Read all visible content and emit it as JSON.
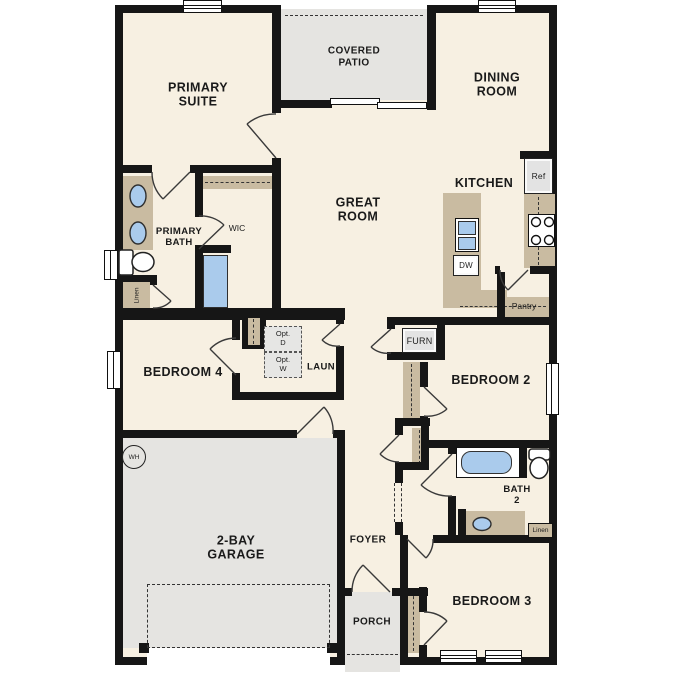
{
  "plan": {
    "colors": {
      "wall": "#161616",
      "floor": "#f7f0e2",
      "outdoor": "#e5e4e1",
      "counter": "#c9bba1",
      "fixture": "#aacbec",
      "appliance": "#e3e3e3",
      "line": "#333333"
    },
    "labels": {
      "primary_suite": "PRIMARY\nSUITE",
      "covered_patio": "COVERED\nPATIO",
      "dining_room": "DINING\nROOM",
      "great_room": "GREAT\nROOM",
      "kitchen": "KITCHEN",
      "primary_bath": "PRIMARY\nBATH",
      "wic": "WIC",
      "bedroom_4": "BEDROOM 4",
      "laundry": "LAUN",
      "opt_dryer": "Opt.\nD",
      "opt_washer": "Opt.\nW",
      "furnace": "FURN",
      "bedroom_2": "BEDROOM 2",
      "bath_2": "BATH\n2",
      "pantry": "Pantry",
      "refrigerator": "Ref",
      "dishwasher": "DW",
      "water_heater": "WH",
      "linen_primary": "Linen",
      "linen_bath2": "Linen",
      "garage": "2-BAY\nGARAGE",
      "foyer": "FOYER",
      "porch": "PORCH",
      "bedroom_3": "BEDROOM 3"
    }
  }
}
